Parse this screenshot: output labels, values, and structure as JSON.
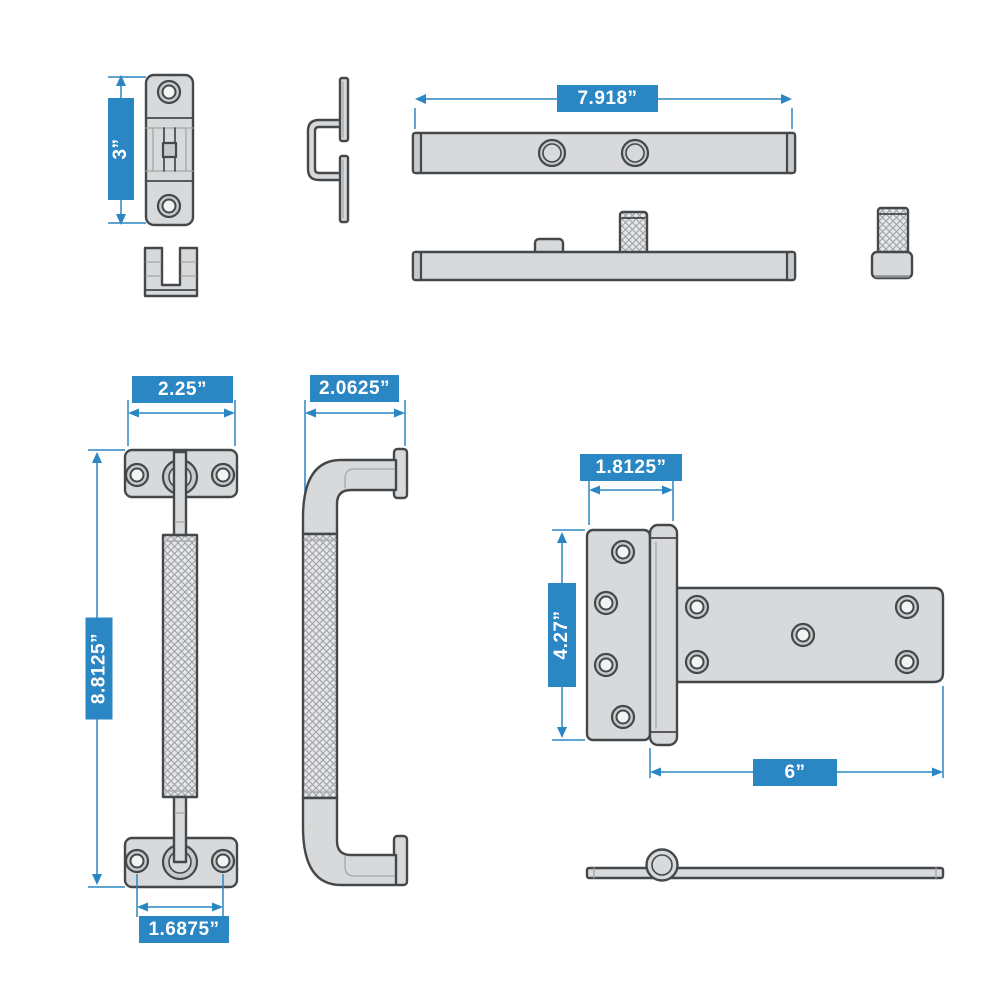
{
  "colors": {
    "accent_blue": "#2b86c4",
    "part_fill": "#d8d9da",
    "part_fill_dark": "#c7c9cb",
    "part_stroke": "#45484a",
    "background": "#ffffff",
    "label_text": "#ffffff"
  },
  "dimensions": {
    "latch_height": "3”",
    "bar_length": "7.918”",
    "handle_width": "2.25”",
    "handle_depth": "2.0625”",
    "handle_height": "8.8125”",
    "handle_hole_spacing": "1.6875”",
    "hinge_plate_width": "1.8125”",
    "hinge_plate_height": "4.27”",
    "hinge_strap_length": "6”"
  }
}
